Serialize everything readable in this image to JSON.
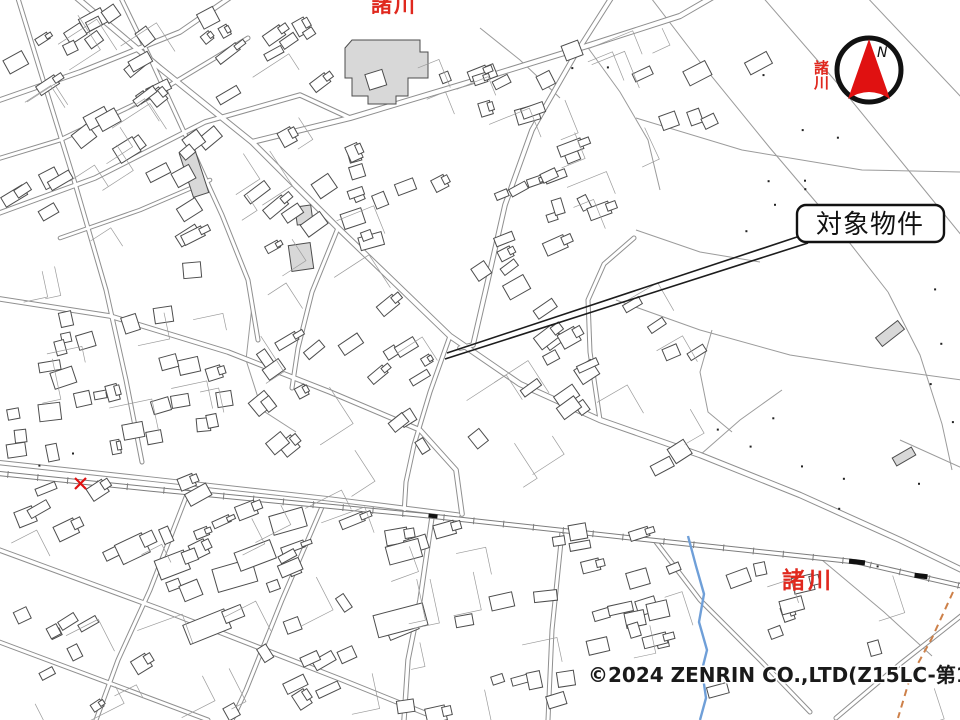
{
  "page": {
    "background": "#ffffff"
  },
  "callout": {
    "label": "対象物件",
    "border_color": "#111111",
    "fill": "#ffffff"
  },
  "compass": {
    "label": "N",
    "arrow_color": "#e01111",
    "ring_color": "#111111"
  },
  "place_labels": {
    "top": "諸川",
    "right": "諸川",
    "bottom_right": "諸川",
    "color": "#e0281e"
  },
  "copyright": {
    "text": "©2024 ZENRIN CO.,LTD(Z15LC-第138号）",
    "color": "#1a1a1a"
  },
  "map_colors": {
    "road_casing": "#8f8f8f",
    "road_fill": "#ffffff",
    "building": "#4d4d4d",
    "parcel": "#9b9b9b",
    "rail": "#7d7d7d",
    "station": "#111111",
    "water": "#6f9fd8",
    "boundary": "#cd8049",
    "landmark_fill": "#d8d8d8",
    "crossing_red": "#e01111",
    "dot": "#222222"
  }
}
